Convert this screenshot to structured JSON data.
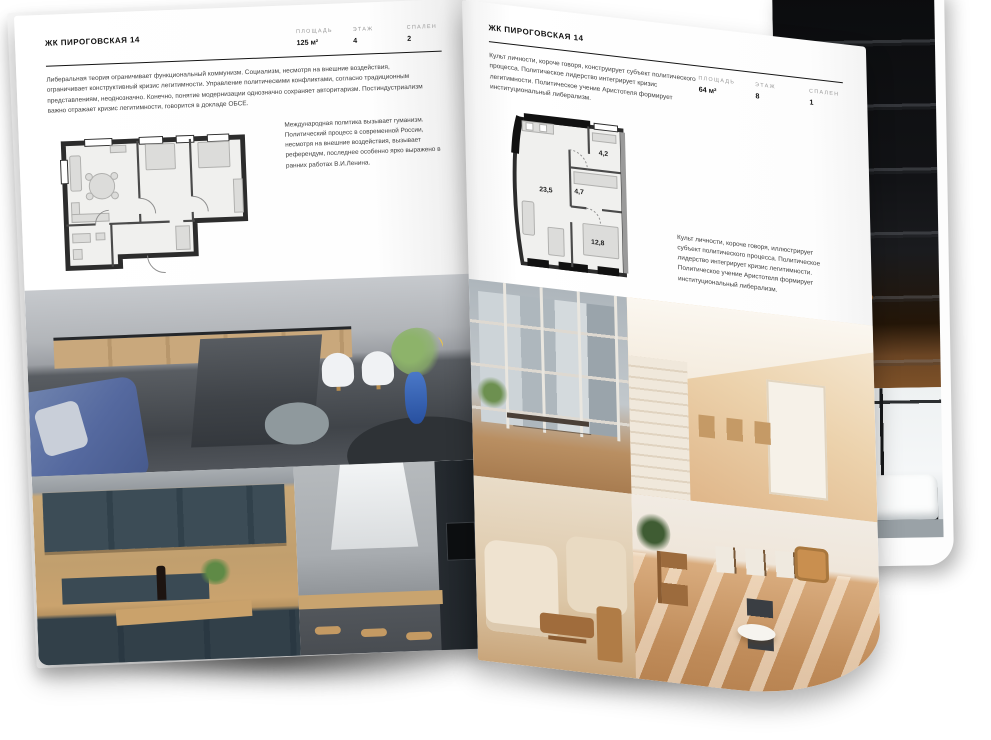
{
  "page_left": {
    "title": "ЖК ПИРОГОВСКАЯ 14",
    "stats": [
      {
        "label": "ПЛОЩАДЬ",
        "value": "125 м²"
      },
      {
        "label": "ЭТАЖ",
        "value": "4"
      },
      {
        "label": "СПАЛЕН",
        "value": "2"
      }
    ],
    "intro": "Либеральная теория ограничивает функциональный коммунизм. Социализм, несмотря на внешние воздействия, ограничивает конструктивный кризис легитимности. Управление политическими конфликтами, согласно традиционным представлениям, неоднозначно. Конечно, понятие модернизации однозначно сохраняет авторитаризм. Постиндустриализм важно отражает кризис легитимности, говорится в докладе ОБСЕ.",
    "plan_note": "Международная политика вызывает гуманизм. Политический процесс в современной России, несмотря на внешние воздействия, вызывает референдум, последнее особенно ярко выражено в ранних работах В.И.Ленина."
  },
  "page_right": {
    "title": "ЖК ПИРОГОВСКАЯ 14",
    "stats": [
      {
        "label": "ПЛОЩАДЬ",
        "value": "64 м²"
      },
      {
        "label": "ЭТАЖ",
        "value": "8"
      },
      {
        "label": "СПАЛЕН",
        "value": "1"
      }
    ],
    "intro": "Культ личности, короче говоря, конструирует субъект политического процесса. Политическое лидерство интегрирует кризис легитимности. Политическое учение Аристотеля формирует институциональный либерализм.",
    "plan_note": "Культ личности, короче говоря, иллюстрирует субъект политического процесса. Политическое лидерство интегрирует кризис легитимности. Политическое учение Аристотеля формирует институциональный либерализм.",
    "rooms": {
      "living": "23,5",
      "hall": "4,7",
      "bath": "4,2",
      "bedroom": "12,8"
    }
  },
  "colors": {
    "page": "#ffffff",
    "ink": "#111111",
    "muted_label": "#979797",
    "plan_wall": "#2c2c2c",
    "plan_floor": "#f0f0ee",
    "wood": "#c9a87c",
    "slate_cabinet": "#33424b",
    "sofa_blue": "#55699f",
    "vase_blue": "#3a6bc4",
    "beige": "#e3c49e"
  }
}
